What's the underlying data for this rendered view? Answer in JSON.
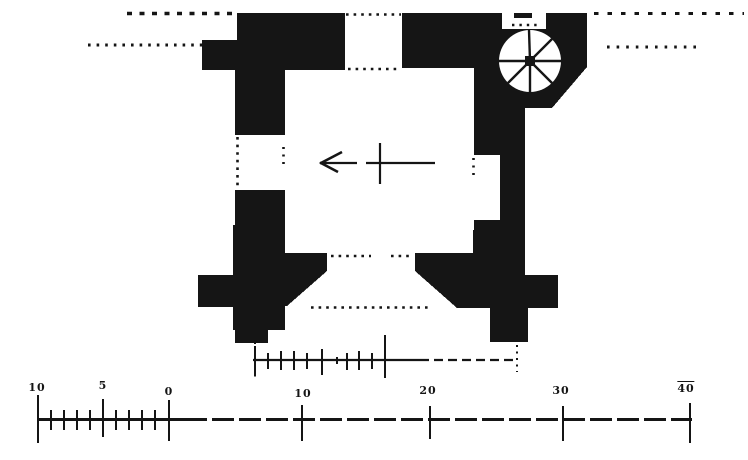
{
  "figure": {
    "type": "castle-tower-floor-plan",
    "ink_color": "#151515",
    "paper_color": "#ffffff",
    "elements": {
      "spiral_staircase": "northeast corner, circular stair with radiating treads",
      "direction_arrow": "arrow pointing left with cross tick in tower interior",
      "entrance": "splayed doorway in south wall",
      "openings": "north wall window opening and west wall doorway shown dotted"
    }
  },
  "scale_bar": {
    "baseline_y": 418,
    "solid_x_start": 38,
    "solid_x_end": 185,
    "dashed_x_end": 692,
    "labels": [
      {
        "text": "10",
        "x": 37,
        "y": 382,
        "overline": false
      },
      {
        "text": "5",
        "x": 103,
        "y": 380,
        "overline": false
      },
      {
        "text": "0",
        "x": 169,
        "y": 386,
        "overline": false
      },
      {
        "text": "10",
        "x": 303,
        "y": 388,
        "overline": false
      },
      {
        "text": "20",
        "x": 428,
        "y": 385,
        "overline": false
      },
      {
        "text": "30",
        "x": 561,
        "y": 385,
        "overline": false
      },
      {
        "text": "40",
        "x": 686,
        "y": 381,
        "overline": true
      }
    ],
    "major_ticks": [
      {
        "x": 38,
        "y1": 395,
        "y2": 443
      },
      {
        "x": 103,
        "y1": 399,
        "y2": 437
      },
      {
        "x": 169,
        "y1": 400,
        "y2": 441
      },
      {
        "x": 302,
        "y1": 405,
        "y2": 441
      },
      {
        "x": 430,
        "y1": 406,
        "y2": 439
      },
      {
        "x": 563,
        "y1": 406,
        "y2": 441
      },
      {
        "x": 690,
        "y1": 403,
        "y2": 443
      }
    ],
    "minor_ticks": [
      51,
      64,
      77,
      90,
      116,
      129,
      142,
      155
    ],
    "minor_y1": 410,
    "minor_y2": 430
  },
  "measuring_rod": {
    "line_y": 360,
    "x_start": 253,
    "x_solid_end": 420,
    "x_end": 517,
    "ticks": [
      {
        "x": 255,
        "y1": 346,
        "y2": 375
      },
      {
        "x": 268,
        "y1": 353,
        "y2": 369
      },
      {
        "x": 281,
        "y1": 351,
        "y2": 370
      },
      {
        "x": 294,
        "y1": 351,
        "y2": 370
      },
      {
        "x": 307,
        "y1": 353,
        "y2": 369
      },
      {
        "x": 322,
        "y1": 349,
        "y2": 375
      },
      {
        "x": 337,
        "y1": 357,
        "y2": 364
      },
      {
        "x": 347,
        "y1": 353,
        "y2": 370
      },
      {
        "x": 359,
        "y1": 351,
        "y2": 370
      },
      {
        "x": 372,
        "y1": 353,
        "y2": 369
      },
      {
        "x": 385,
        "y1": 335,
        "y2": 378
      }
    ]
  }
}
